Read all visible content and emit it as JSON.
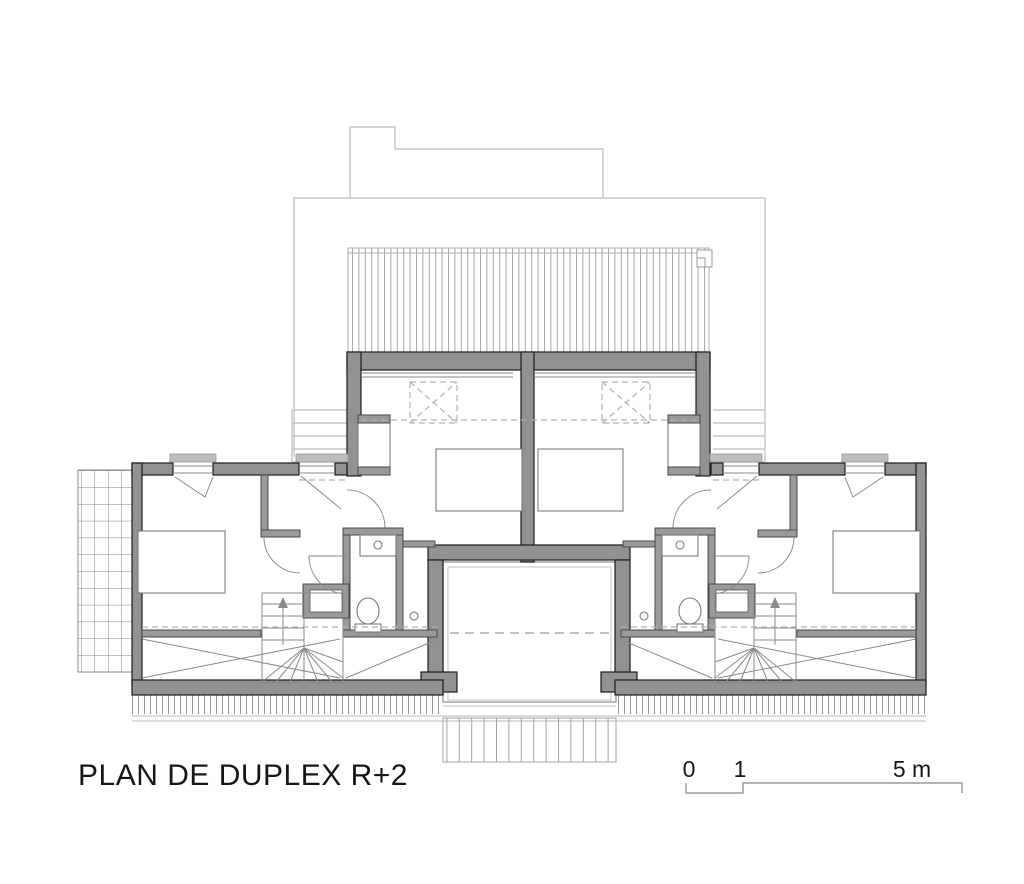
{
  "title": "PLAN DE DUPLEX R+2",
  "scale_bar": {
    "tick_0": "0",
    "tick_1": "1",
    "tick_5": "5 m"
  },
  "colors": {
    "wall_fill": "#929292",
    "wall_edge": "#1c1c1c",
    "light_outline": "#c6c6c6",
    "hatch": "#a4a4a4",
    "dashed": "#b2b2b2",
    "background": "#ffffff",
    "text": "#161616"
  },
  "plan": {
    "type": "architectural-floor-plan",
    "floor_label": "R+2",
    "symmetry": "two mirrored duplex units",
    "elements": [
      "lower-floor-outline",
      "roof-deck",
      "exterior-steps",
      "central-bedrooms with skylights, beds, wardrobes",
      "left-wing bedroom, bathroom (sink, wc), shower, winder-stair, closet",
      "right-wing bedroom, bathroom (sink, wc), shower, winder-stair, closet",
      "central-void with balcony",
      "trellis-grid-west",
      "eave-hatch-south"
    ]
  }
}
